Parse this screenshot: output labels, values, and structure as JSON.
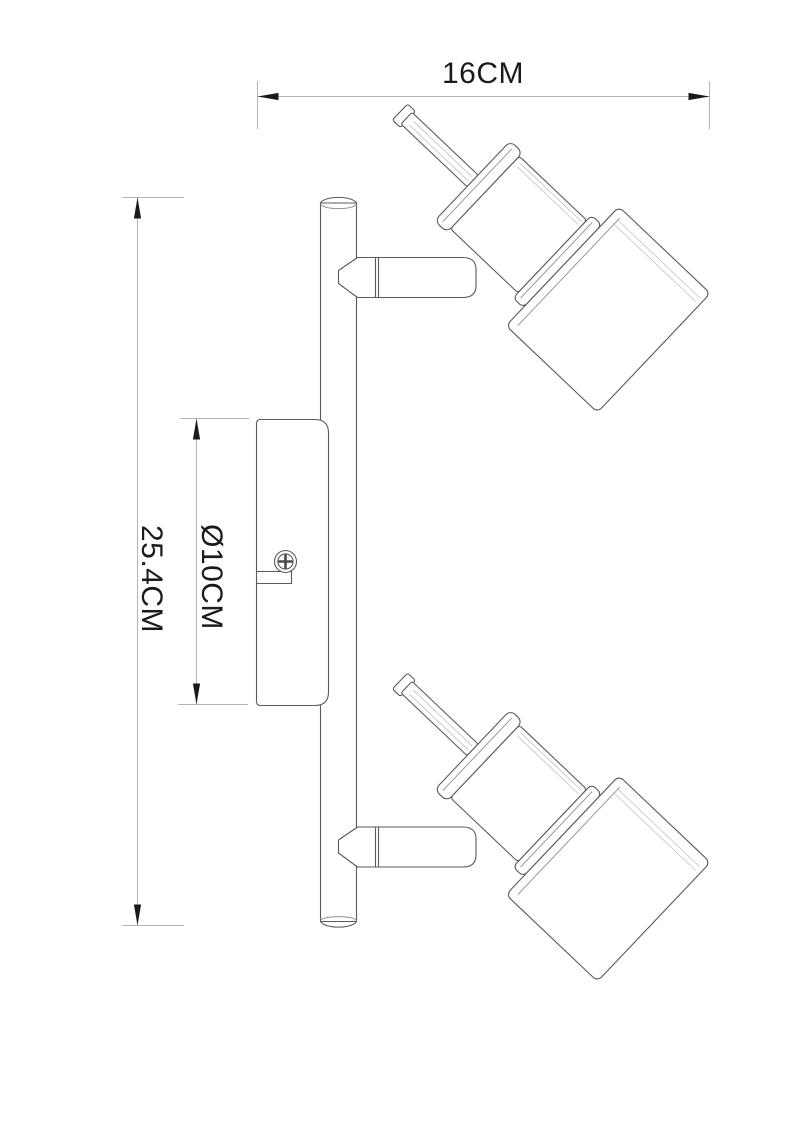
{
  "dimensions": {
    "width_label": "16CM",
    "height_label": "25.4CM",
    "canopy_diameter_label": "Ø10CM"
  },
  "colors": {
    "background": "#ffffff",
    "fixture_outline": "#5a5a5a",
    "highlight_line": "#c2c2c2",
    "dimension_line": "#b4b4b4",
    "arrow_and_text": "#1a1a1a"
  }
}
